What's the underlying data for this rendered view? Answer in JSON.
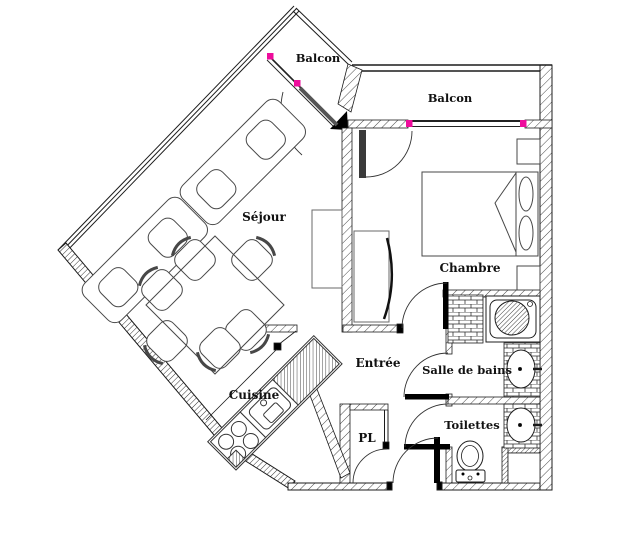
{
  "title": "Plan d'appartement",
  "rooms": {
    "balcon_diag": {
      "label": "Balcon"
    },
    "balcon_top": {
      "label": "Balcon"
    },
    "sejour": {
      "label": "Séjour"
    },
    "chambre": {
      "label": "Chambre"
    },
    "cuisine": {
      "label": "Cuisine"
    },
    "entree": {
      "label": "Entrée"
    },
    "pl": {
      "label": "PL"
    },
    "salle_de_bains": {
      "label": "Salle de bains"
    },
    "toilettes": {
      "label": "Toilettes"
    }
  },
  "colors": {
    "line": "#1c1c1c",
    "furniture": "#474747",
    "hatch": "#3f3f3f",
    "magenta": "#ee0c9c",
    "door": "#000000",
    "background": "#ffffff"
  }
}
